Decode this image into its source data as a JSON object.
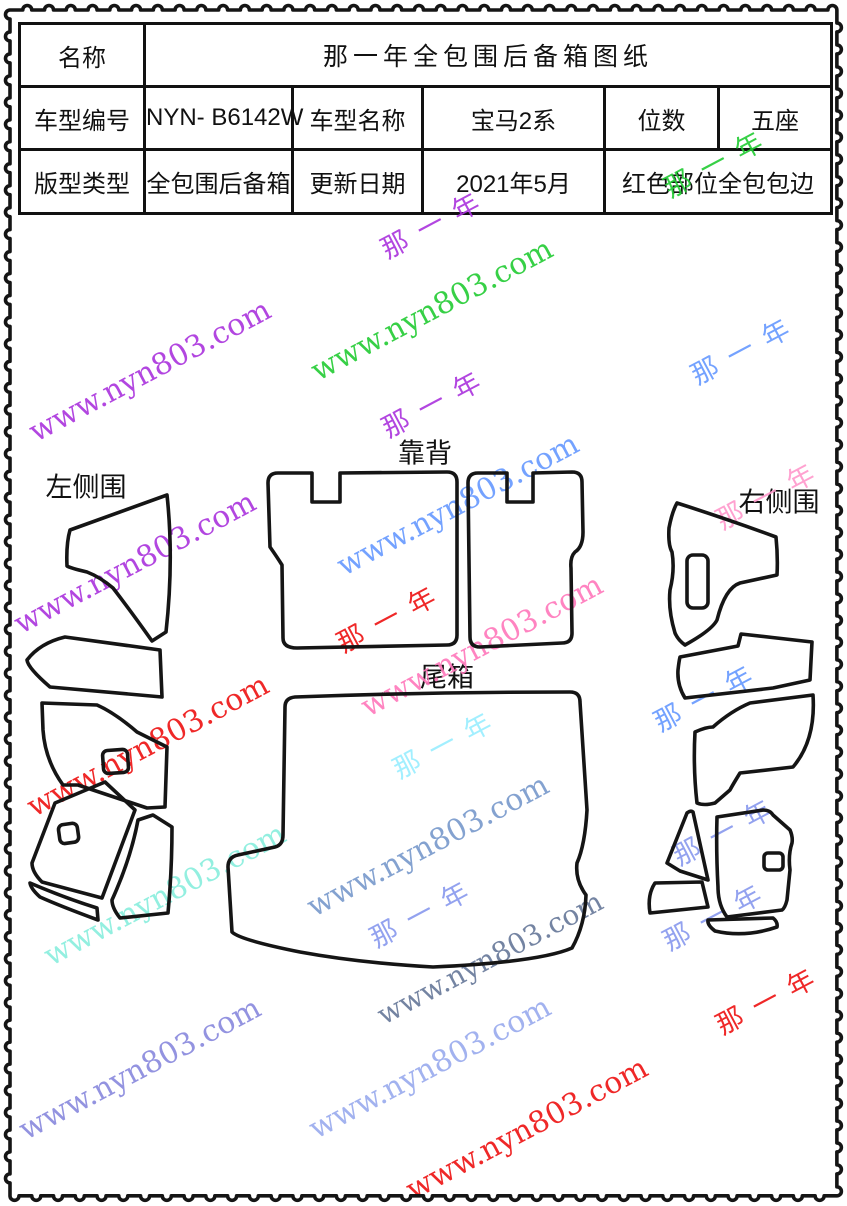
{
  "page": {
    "width": 847,
    "height": 1206,
    "background": "#ffffff",
    "border_color": "#111111"
  },
  "table": {
    "name_label": "名称",
    "name_value": "那一年全包围后备箱图纸",
    "model_code_label": "车型编号",
    "model_code_value": "NYN- B6142W",
    "model_name_label": "车型名称",
    "model_name_value": "宝马2系",
    "seats_label": "位数",
    "seats_value": "五座",
    "pattern_type_label": "版型类型",
    "pattern_type_value": "全包围后备箱",
    "update_date_label": "更新日期",
    "update_date_value": "2021年5月",
    "note_value": "红色部位全包包边"
  },
  "diagram": {
    "labels": [
      {
        "id": "backrest",
        "text": "靠背",
        "x": 425,
        "y": 451
      },
      {
        "id": "left-side",
        "text": "左侧围",
        "x": 86,
        "y": 485
      },
      {
        "id": "right-side",
        "text": "右侧围",
        "x": 779,
        "y": 500
      },
      {
        "id": "trunk",
        "text": "尾箱",
        "x": 447,
        "y": 675
      }
    ]
  },
  "watermarks": {
    "site_text": "www.nyn803.com",
    "brand_text": "那一年",
    "items": [
      {
        "text": "那一年",
        "color": "#22cc33",
        "x": 718,
        "y": 160,
        "size": 27
      },
      {
        "text": "那一年",
        "color": "#aa33dd",
        "x": 435,
        "y": 221,
        "size": 27
      },
      {
        "text": "www.nyn803.com",
        "color": "#aa33dd",
        "x": 150,
        "y": 371,
        "size": 30
      },
      {
        "text": "www.nyn803.com",
        "color": "#22cc33",
        "x": 432,
        "y": 310,
        "size": 30
      },
      {
        "text": "那一年",
        "color": "#6699ff",
        "x": 745,
        "y": 347,
        "size": 27
      },
      {
        "text": "那一年",
        "color": "#aa33dd",
        "x": 436,
        "y": 400,
        "size": 27
      },
      {
        "text": "那一年",
        "color": "#ff99cc",
        "x": 770,
        "y": 492,
        "size": 27
      },
      {
        "text": "www.nyn803.com",
        "color": "#aa33dd",
        "x": 135,
        "y": 563,
        "size": 30
      },
      {
        "text": "www.nyn803.com",
        "color": "#6699ff",
        "x": 458,
        "y": 505,
        "size": 30
      },
      {
        "text": "那一年",
        "color": "#ee1111",
        "x": 391,
        "y": 615,
        "size": 27
      },
      {
        "text": "www.nyn803.com",
        "color": "#ff77bb",
        "x": 482,
        "y": 646,
        "size": 30
      },
      {
        "text": "www.nyn803.com",
        "color": "#ee1111",
        "x": 148,
        "y": 746,
        "size": 30
      },
      {
        "text": "那一年",
        "color": "#99eeff",
        "x": 447,
        "y": 741,
        "size": 27
      },
      {
        "text": "www.nyn803.com",
        "color": "#88eedd",
        "x": 165,
        "y": 895,
        "size": 30
      },
      {
        "text": "www.nyn803.com",
        "color": "#7799cc",
        "x": 428,
        "y": 846,
        "size": 30
      },
      {
        "text": "那一年",
        "color": "#8899ee",
        "x": 424,
        "y": 910,
        "size": 27
      },
      {
        "text": "那一年",
        "color": "#6699ff",
        "x": 708,
        "y": 694,
        "size": 27
      },
      {
        "text": "那一年",
        "color": "#8899ee",
        "x": 727,
        "y": 828,
        "size": 27
      },
      {
        "text": "那一年",
        "color": "#8899ee",
        "x": 717,
        "y": 913,
        "size": 27
      },
      {
        "text": "www.nyn803.com",
        "color": "#667799",
        "x": 490,
        "y": 958,
        "size": 28
      },
      {
        "text": "www.nyn803.com",
        "color": "#8888dd",
        "x": 140,
        "y": 1069,
        "size": 30
      },
      {
        "text": "www.nyn803.com",
        "color": "#99aaee",
        "x": 430,
        "y": 1068,
        "size": 30
      },
      {
        "text": "www.nyn803.com",
        "color": "#ee1111",
        "x": 527,
        "y": 1129,
        "size": 30
      },
      {
        "text": "那一年",
        "color": "#ee1111",
        "x": 770,
        "y": 997,
        "size": 27
      }
    ]
  }
}
